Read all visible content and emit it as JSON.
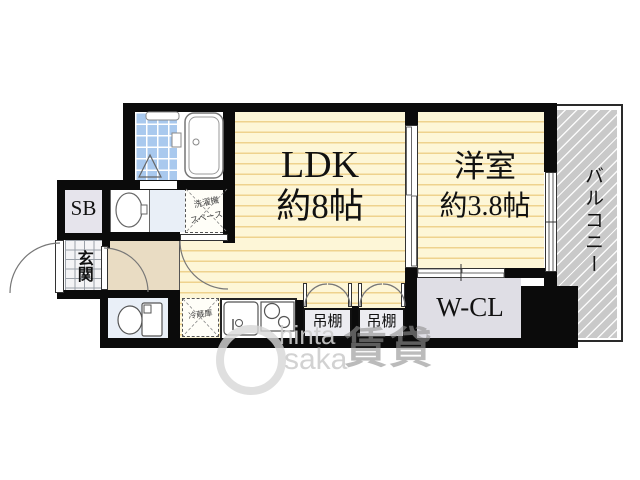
{
  "floorplan": {
    "rooms": {
      "ldk": {
        "name": "LDK",
        "size": "約8帖"
      },
      "western": {
        "name": "洋室",
        "size": "約3.8帖"
      },
      "balcony": {
        "name": "バルコニー"
      },
      "wcl": {
        "name": "W-CL"
      },
      "shoebox": {
        "name": "SB"
      },
      "entrance": {
        "name": "玄関"
      }
    },
    "fixtures": {
      "shelf1": "吊棚",
      "shelf2": "吊棚",
      "fridge": "冷蔵庫",
      "washer_line1": "洗濯機",
      "washer_line2": "スペース"
    },
    "watermark": {
      "latin1": "hinta",
      "latin2": "saka",
      "kanji": "賃貸"
    },
    "colors": {
      "wall": "#0b0b0b",
      "room_yellow": "#fdf6d7",
      "floor_stripe": "#eed28e",
      "bath_tile_blue": "#a9c9ee",
      "sanitary_blue": "#e9eff7",
      "hallway_beige": "#e9dcc3",
      "closet_gray": "#dfdee5",
      "balcony_gray": "#c9c9c9",
      "watermark_gray": "#d6d6d6"
    }
  }
}
